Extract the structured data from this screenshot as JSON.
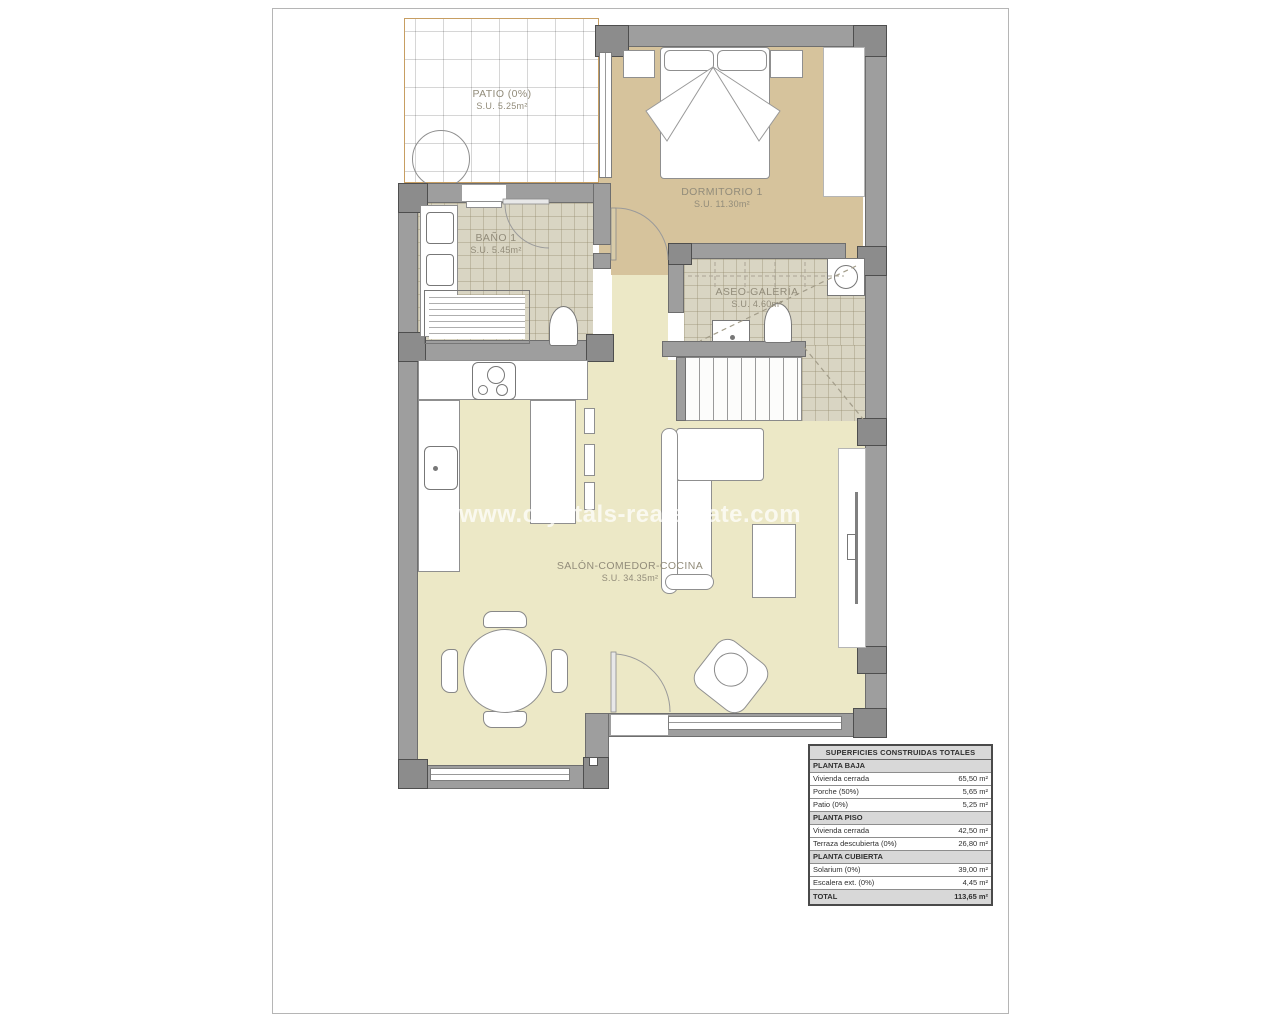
{
  "page": {
    "background": "#ffffff",
    "sheet_border": "#b5b5b5"
  },
  "watermark": {
    "text": "www.crystals-realestate.com",
    "color": "rgba(255,255,255,0.72)"
  },
  "floorplan": {
    "colors": {
      "wall": "#9e9e9e",
      "pillar": "#8c8c8c",
      "bedroom_floor": "#d6c39c",
      "living_floor": "#ece8c6",
      "tile_floor": "#d9d5c3",
      "patio_border": "#c79e62",
      "label_text": "#928c7a"
    },
    "rooms": [
      {
        "name": "PATIO (0%)",
        "area": "S.U. 5.25m²"
      },
      {
        "name": "DORMITORIO 1",
        "area": "S.U. 11.30m²"
      },
      {
        "name": "BAÑO 1",
        "area": "S.U. 5.45m²"
      },
      {
        "name": "ASEO-GALERÍA",
        "area": "S.U. 4.60m²"
      },
      {
        "name": "SALÓN-COMEDOR-COCINA",
        "area": "S.U. 34.35m²"
      }
    ]
  },
  "areas_table": {
    "title": "SUPERFICIES CONSTRUIDAS TOTALES",
    "sections": [
      {
        "header": "PLANTA BAJA",
        "rows": [
          [
            "Vivienda cerrada",
            "65,50 m²"
          ],
          [
            "Porche (50%)",
            "5,65 m²"
          ],
          [
            "Patio (0%)",
            "5,25 m²"
          ]
        ]
      },
      {
        "header": "PLANTA PISO",
        "rows": [
          [
            "Vivienda cerrada",
            "42,50 m²"
          ],
          [
            "Terraza descubierta (0%)",
            "26,80 m²"
          ]
        ]
      },
      {
        "header": "PLANTA CUBIERTA",
        "rows": [
          [
            "Solarium (0%)",
            "39,00 m²"
          ],
          [
            "Escalera ext. (0%)",
            "4,45 m²"
          ]
        ]
      }
    ],
    "total": {
      "label": "TOTAL",
      "value": "113,65 m²"
    }
  }
}
